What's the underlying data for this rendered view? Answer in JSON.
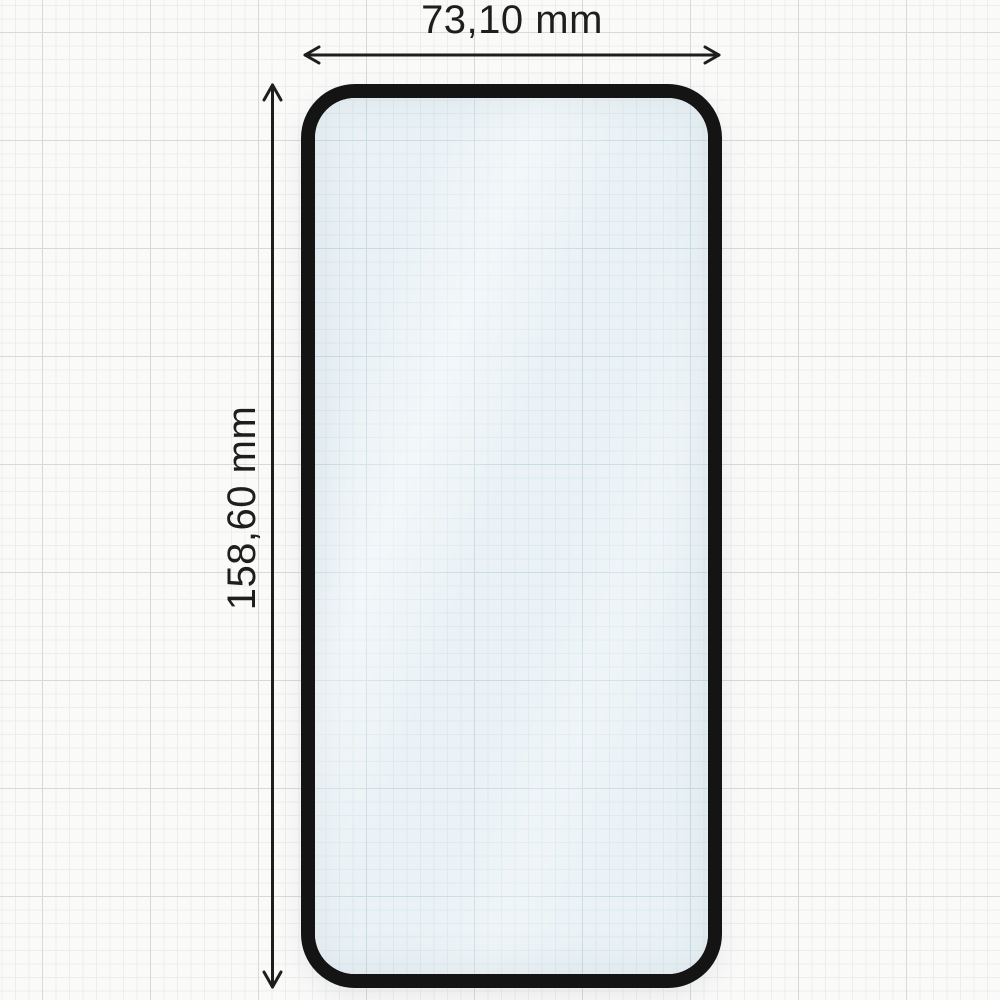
{
  "figure": {
    "type": "dimension-diagram",
    "subject": "tempered-glass-screen-protector",
    "width_dimension": {
      "label": "73,10 mm",
      "value_mm": 73.1
    },
    "height_dimension": {
      "label": "158,60 mm",
      "value_mm": 158.6
    }
  },
  "icons": {
    "width_arrow": "double-headed-horizontal-arrow",
    "height_arrow": "double-headed-vertical-arrow"
  },
  "colors": {
    "paper": "#fafaf9",
    "grid_minor": "#ededec",
    "grid_major": "#d8d8d6",
    "glass_fill": "#eaf2f5",
    "glass_grid_minor": "#dce9ee",
    "glass_grid_major": "#c8dce4",
    "glass_border": "#141414",
    "dimension_color": "#1e1e1e"
  }
}
